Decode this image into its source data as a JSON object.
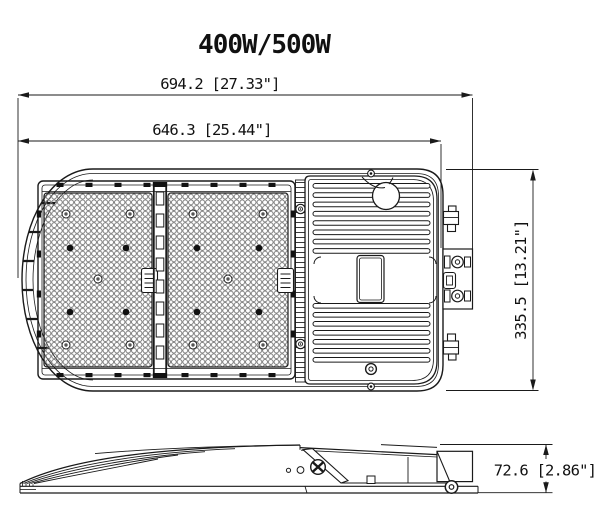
{
  "title": "400W/500W",
  "dimensions": {
    "overall_length": "694.2 [27.33\"]",
    "housing_length": "646.3 [25.44\"]",
    "width": "335.5 [13.21\"]",
    "height": "72.6 [2.86\"]"
  }
}
